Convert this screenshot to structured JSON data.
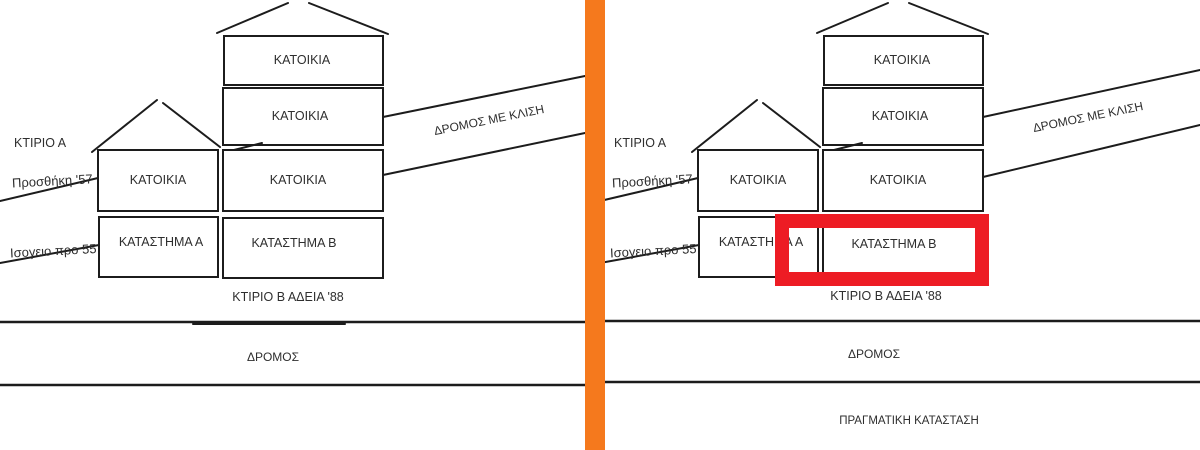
{
  "colors": {
    "divider_orange": "#F5791D",
    "highlight_red": "#ED1C24",
    "ink": "#1c1c1c",
    "text": "#2e2e2e"
  },
  "panels": {
    "left": {
      "ktirio_a": "ΚΤΙΡΙΟ Α",
      "prosthiki": "Προσθήκη '57",
      "isogeio": "Ισογειο προ 55",
      "residence": "ΚΑΤΟΙΚΙΑ",
      "shop_a": "ΚΑΤΑΣΤΗΜΑ Α",
      "shop_b": "ΚΑΤΑΣΤΗΜΑ Β",
      "sloped_road": "ΔΡΟΜΟΣ ΜΕ ΚΛΙΣΗ",
      "permit": "ΚΤΙΡΙΟ Β ΑΔΕΙΑ '88",
      "road": "ΔΡΟΜΟΣ"
    },
    "right": {
      "ktirio_a": "ΚΤΙΡΙΟ Α",
      "prosthiki": "Προσθήκη '57",
      "isogeio": "Ισογειο προ 55",
      "residence": "ΚΑΤΟΙΚΙΑ",
      "shop_a": "ΚΑΤΑΣΤΗΜΑ Α",
      "shop_b": "ΚΑΤΑΣΤΗΜΑ Β",
      "sloped_road": "ΔΡΟΜΟΣ ΜΕ ΚΛΙΣΗ",
      "permit": "ΚΤΙΡΙΟ Β ΑΔΕΙΑ '88",
      "road": "ΔΡΟΜΟΣ",
      "caption": "ΠΡΑΓΜΑΤΙΚΗ ΚΑΤΑΣΤΑΣΗ"
    }
  }
}
